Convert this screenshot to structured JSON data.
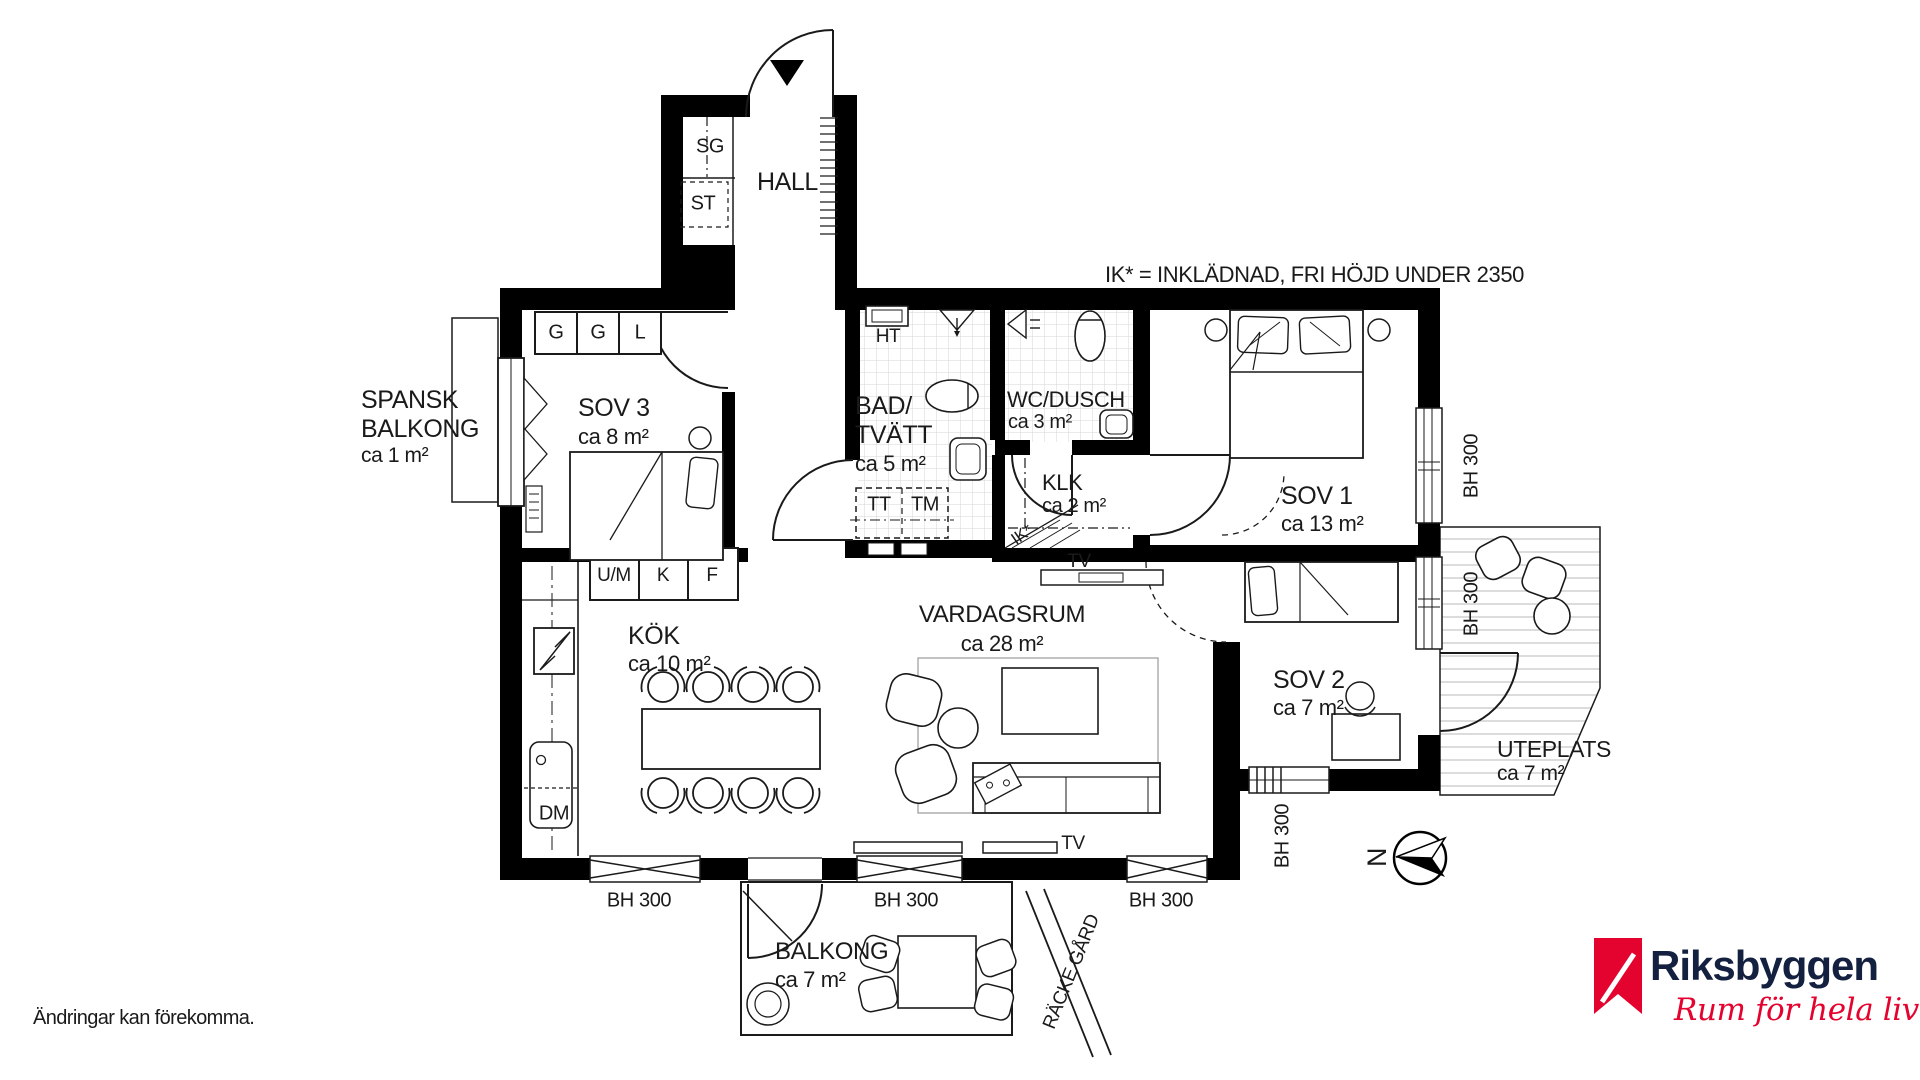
{
  "notes": {
    "ik_note": "IK* = INKLÄDNAD, FRI HÖJD UNDER 2350",
    "disclaimer": "Ändringar kan förekomma."
  },
  "rooms": {
    "hall": {
      "name": "HALL"
    },
    "sov3": {
      "name": "SOV 3",
      "area": "ca 8 m²"
    },
    "spansk": {
      "line1": "SPANSK",
      "line2": "BALKONG",
      "area": "ca 1 m²"
    },
    "bad": {
      "line1": "BAD/",
      "line2": "TVÄTT",
      "area": "ca 5 m²"
    },
    "wc": {
      "name": "WC/DUSCH",
      "area": "ca 3 m²"
    },
    "klk": {
      "name": "KLK",
      "area": "ca 2 m²"
    },
    "sov1": {
      "name": "SOV 1",
      "area": "ca 13 m²"
    },
    "sov2": {
      "name": "SOV 2",
      "area": "ca 7 m²"
    },
    "vardagsrum": {
      "name": "VARDAGSRUM",
      "area": "ca 28 m²"
    },
    "kok": {
      "name": "KÖK",
      "area": "ca 10 m²"
    },
    "uteplats": {
      "name": "UTEPLATS",
      "area": "ca 7 m²"
    },
    "balkong": {
      "name": "BALKONG",
      "area": "ca 7 m²"
    }
  },
  "labels": {
    "sg": "SG",
    "st": "ST",
    "g": "G",
    "l": "L",
    "um": "U/M",
    "k": "K",
    "f": "F",
    "ht": "HT",
    "tt": "TT",
    "tm": "TM",
    "dm": "DM",
    "tv": "TV",
    "ik_star": "IK*",
    "bh300": "BH 300",
    "racke_gard": "RÄCKE GÅRD",
    "north": "N"
  },
  "brand": {
    "name": "Riksbyggen",
    "tagline": "Rum för hela livet",
    "mark_color": "#e4032e",
    "name_color": "#14203f",
    "tagline_color": "#e4032e"
  }
}
